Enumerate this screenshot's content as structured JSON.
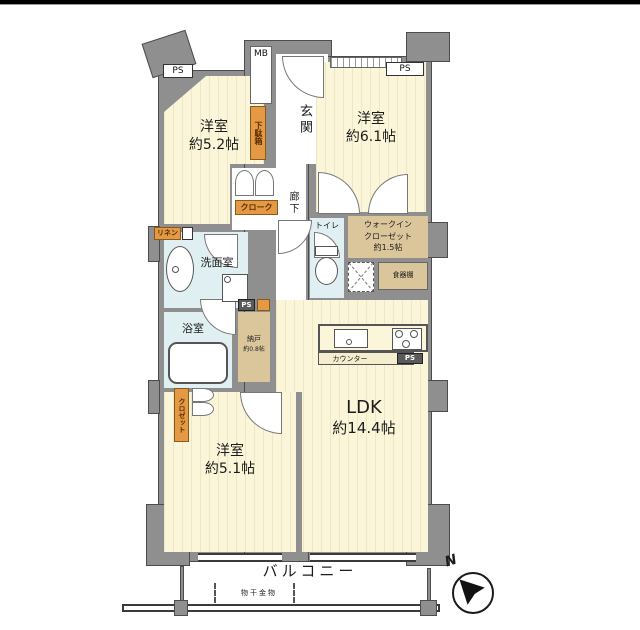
{
  "colors": {
    "wall": "#8f8f8f",
    "room_cream": "#fbf6d9",
    "wet_area_blue": "#e0f0f2",
    "storage_tan": "#dbc69b",
    "tag_orange": "#e49a44"
  },
  "rooms": {
    "bedroom_nw": {
      "name": "洋室",
      "size": "約5.2帖"
    },
    "bedroom_ne": {
      "name": "洋室",
      "size": "約6.1帖"
    },
    "bedroom_sw": {
      "name": "洋室",
      "size": "約5.1帖"
    },
    "ldk": {
      "name": "LDK",
      "size": "約14.4帖"
    },
    "entrance": {
      "name": "玄関"
    },
    "hallway": {
      "name": "廊下"
    },
    "washroom": {
      "name": "洗面室"
    },
    "bathroom": {
      "name": "浴室"
    },
    "toilet": {
      "name": "トイレ"
    },
    "walk_in_closet": {
      "line1": "ウォークイン",
      "line2": "クローゼット",
      "size": "約1.5帖"
    },
    "storage_room": {
      "name": "納戸",
      "size": "約0.8帖"
    },
    "balcony": {
      "name": "バルコニー"
    }
  },
  "tags": {
    "ps": "PS",
    "mb": "MB",
    "shoe_cabinet": "下駄箱",
    "cloak": "クローク",
    "closet": "クロゼット",
    "linen": "リネン",
    "cupboard": "食器棚",
    "counter": "カウンター",
    "laundry_hardware": "物干金物"
  },
  "compass": {
    "north": "N"
  }
}
